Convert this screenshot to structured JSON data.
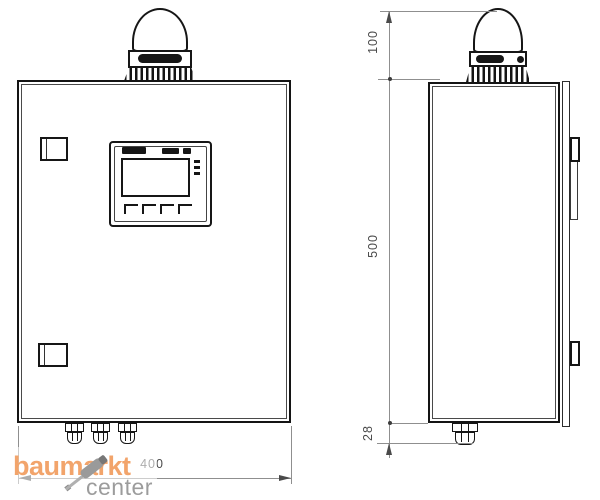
{
  "drawing": {
    "type": "technical-dimension-drawing",
    "subject": "control-cabinet-with-signal-beacon",
    "views": {
      "left": "front-view",
      "right": "side-view"
    },
    "dimensions": {
      "beacon_height": "100",
      "cabinet_height": "500",
      "gland_height": "28",
      "cabinet_width": "400"
    },
    "colors": {
      "line": "#161616",
      "dimension_line": "#8f8f8f",
      "dimension_text": "#4a4a4a"
    }
  },
  "watermark": {
    "brand": "baumarkt",
    "suffix": "center",
    "brand_color": "#F2A46B",
    "suffix_color": "#9C9C9C",
    "icon": "screwdriver"
  }
}
